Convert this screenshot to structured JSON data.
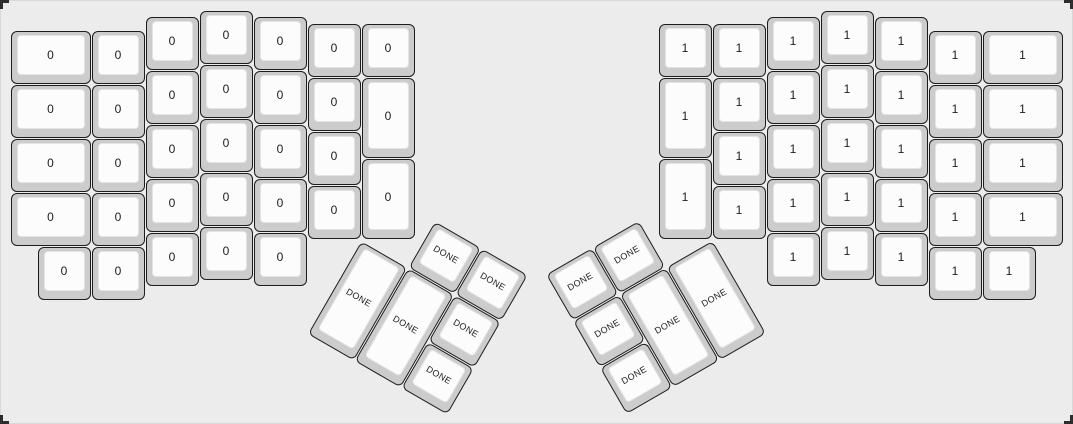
{
  "app": {
    "description": "keyboard-layout-editor canvas showing an ErgoDox split keyboard",
    "colors": {
      "bg": "#ececec",
      "canvas_border": "#d8d8d8",
      "cap_base": "#cccccc",
      "cap_border": "#1d1d1d",
      "cap_top": "#fcfcfc",
      "cap_top_border": "#e4e4e4",
      "label": "#1c1c1c",
      "corner_mark": "#2d2d2d"
    }
  },
  "keyboard": {
    "unit_px": 54,
    "origin": {
      "x": 10,
      "y": 10
    },
    "left_half_label": "0",
    "right_half_label": "1",
    "thumb_label": "DONE",
    "keys": [
      {
        "x": 0,
        "y": 0.375,
        "w": 1.5,
        "label": "0"
      },
      {
        "x": 0,
        "y": 1.375,
        "w": 1.5,
        "label": "0"
      },
      {
        "x": 0,
        "y": 2.375,
        "w": 1.5,
        "label": "0"
      },
      {
        "x": 0,
        "y": 3.375,
        "w": 1.5,
        "label": "0"
      },
      {
        "x": 0.5,
        "y": 4.375,
        "label": "0"
      },
      {
        "x": 1.5,
        "y": 0.375,
        "label": "0"
      },
      {
        "x": 1.5,
        "y": 1.375,
        "label": "0"
      },
      {
        "x": 1.5,
        "y": 2.375,
        "label": "0"
      },
      {
        "x": 1.5,
        "y": 3.375,
        "label": "0"
      },
      {
        "x": 1.5,
        "y": 4.375,
        "label": "0"
      },
      {
        "x": 2.5,
        "y": 0.125,
        "label": "0"
      },
      {
        "x": 2.5,
        "y": 1.125,
        "label": "0"
      },
      {
        "x": 2.5,
        "y": 2.125,
        "label": "0"
      },
      {
        "x": 2.5,
        "y": 3.125,
        "label": "0"
      },
      {
        "x": 2.5,
        "y": 4.125,
        "label": "0"
      },
      {
        "x": 3.5,
        "y": 0,
        "label": "0"
      },
      {
        "x": 3.5,
        "y": 1,
        "label": "0"
      },
      {
        "x": 3.5,
        "y": 2,
        "label": "0"
      },
      {
        "x": 3.5,
        "y": 3,
        "label": "0"
      },
      {
        "x": 3.5,
        "y": 4,
        "label": "0"
      },
      {
        "x": 4.5,
        "y": 0.125,
        "label": "0"
      },
      {
        "x": 4.5,
        "y": 1.125,
        "label": "0"
      },
      {
        "x": 4.5,
        "y": 2.125,
        "label": "0"
      },
      {
        "x": 4.5,
        "y": 3.125,
        "label": "0"
      },
      {
        "x": 4.5,
        "y": 4.125,
        "label": "0"
      },
      {
        "x": 5.5,
        "y": 0.25,
        "label": "0"
      },
      {
        "x": 5.5,
        "y": 1.25,
        "label": "0"
      },
      {
        "x": 5.5,
        "y": 2.25,
        "label": "0"
      },
      {
        "x": 5.5,
        "y": 3.25,
        "label": "0"
      },
      {
        "x": 6.5,
        "y": 0.25,
        "label": "0"
      },
      {
        "x": 6.5,
        "y": 1.25,
        "h": 1.5,
        "label": "0"
      },
      {
        "x": 6.5,
        "y": 2.75,
        "h": 1.5,
        "label": "0"
      },
      {
        "x": 7.5,
        "y": 3.25,
        "label": "DONE",
        "rot": 30,
        "rx": 6.5,
        "ry": 4.25
      },
      {
        "x": 8.5,
        "y": 3.25,
        "label": "DONE",
        "rot": 30,
        "rx": 6.5,
        "ry": 4.25
      },
      {
        "x": 6.5,
        "y": 4.25,
        "h": 2,
        "label": "DONE",
        "rot": 30,
        "rx": 6.5,
        "ry": 4.25
      },
      {
        "x": 7.5,
        "y": 4.25,
        "h": 2,
        "label": "DONE",
        "rot": 30,
        "rx": 6.5,
        "ry": 4.25
      },
      {
        "x": 8.5,
        "y": 4.25,
        "label": "DONE",
        "rot": 30,
        "rx": 6.5,
        "ry": 4.25
      },
      {
        "x": 8.5,
        "y": 5.25,
        "label": "DONE",
        "rot": 30,
        "rx": 6.5,
        "ry": 4.25
      },
      {
        "x": 10,
        "y": 3.25,
        "label": "DONE",
        "rot": -30,
        "rx": 13,
        "ry": 4.25
      },
      {
        "x": 11,
        "y": 3.25,
        "label": "DONE",
        "rot": -30,
        "rx": 13,
        "ry": 4.25
      },
      {
        "x": 10,
        "y": 4.25,
        "label": "DONE",
        "rot": -30,
        "rx": 13,
        "ry": 4.25
      },
      {
        "x": 11,
        "y": 4.25,
        "h": 2,
        "label": "DONE",
        "rot": -30,
        "rx": 13,
        "ry": 4.25
      },
      {
        "x": 12,
        "y": 4.25,
        "h": 2,
        "label": "DONE",
        "rot": -30,
        "rx": 13,
        "ry": 4.25
      },
      {
        "x": 10,
        "y": 5.25,
        "label": "DONE",
        "rot": -30,
        "rx": 13,
        "ry": 4.25
      },
      {
        "x": 12,
        "y": 0.25,
        "label": "1"
      },
      {
        "x": 12,
        "y": 1.25,
        "h": 1.5,
        "label": "1"
      },
      {
        "x": 12,
        "y": 2.75,
        "h": 1.5,
        "label": "1"
      },
      {
        "x": 13,
        "y": 0.25,
        "label": "1"
      },
      {
        "x": 13,
        "y": 1.25,
        "label": "1"
      },
      {
        "x": 13,
        "y": 2.25,
        "label": "1"
      },
      {
        "x": 13,
        "y": 3.25,
        "label": "1"
      },
      {
        "x": 14,
        "y": 0.125,
        "label": "1"
      },
      {
        "x": 14,
        "y": 1.125,
        "label": "1"
      },
      {
        "x": 14,
        "y": 2.125,
        "label": "1"
      },
      {
        "x": 14,
        "y": 3.125,
        "label": "1"
      },
      {
        "x": 14,
        "y": 4.125,
        "label": "1"
      },
      {
        "x": 15,
        "y": 0,
        "label": "1"
      },
      {
        "x": 15,
        "y": 1,
        "label": "1"
      },
      {
        "x": 15,
        "y": 2,
        "label": "1"
      },
      {
        "x": 15,
        "y": 3,
        "label": "1"
      },
      {
        "x": 15,
        "y": 4,
        "label": "1"
      },
      {
        "x": 16,
        "y": 0.125,
        "label": "1"
      },
      {
        "x": 16,
        "y": 1.125,
        "label": "1"
      },
      {
        "x": 16,
        "y": 2.125,
        "label": "1"
      },
      {
        "x": 16,
        "y": 3.125,
        "label": "1"
      },
      {
        "x": 16,
        "y": 4.125,
        "label": "1"
      },
      {
        "x": 17,
        "y": 0.375,
        "label": "1"
      },
      {
        "x": 17,
        "y": 1.375,
        "label": "1"
      },
      {
        "x": 17,
        "y": 2.375,
        "label": "1"
      },
      {
        "x": 17,
        "y": 3.375,
        "label": "1"
      },
      {
        "x": 17,
        "y": 4.375,
        "label": "1"
      },
      {
        "x": 18,
        "y": 0.375,
        "w": 1.5,
        "label": "1"
      },
      {
        "x": 18,
        "y": 1.375,
        "w": 1.5,
        "label": "1"
      },
      {
        "x": 18,
        "y": 2.375,
        "w": 1.5,
        "label": "1"
      },
      {
        "x": 18,
        "y": 3.375,
        "w": 1.5,
        "label": "1"
      },
      {
        "x": 18,
        "y": 4.375,
        "label": "1"
      }
    ]
  }
}
